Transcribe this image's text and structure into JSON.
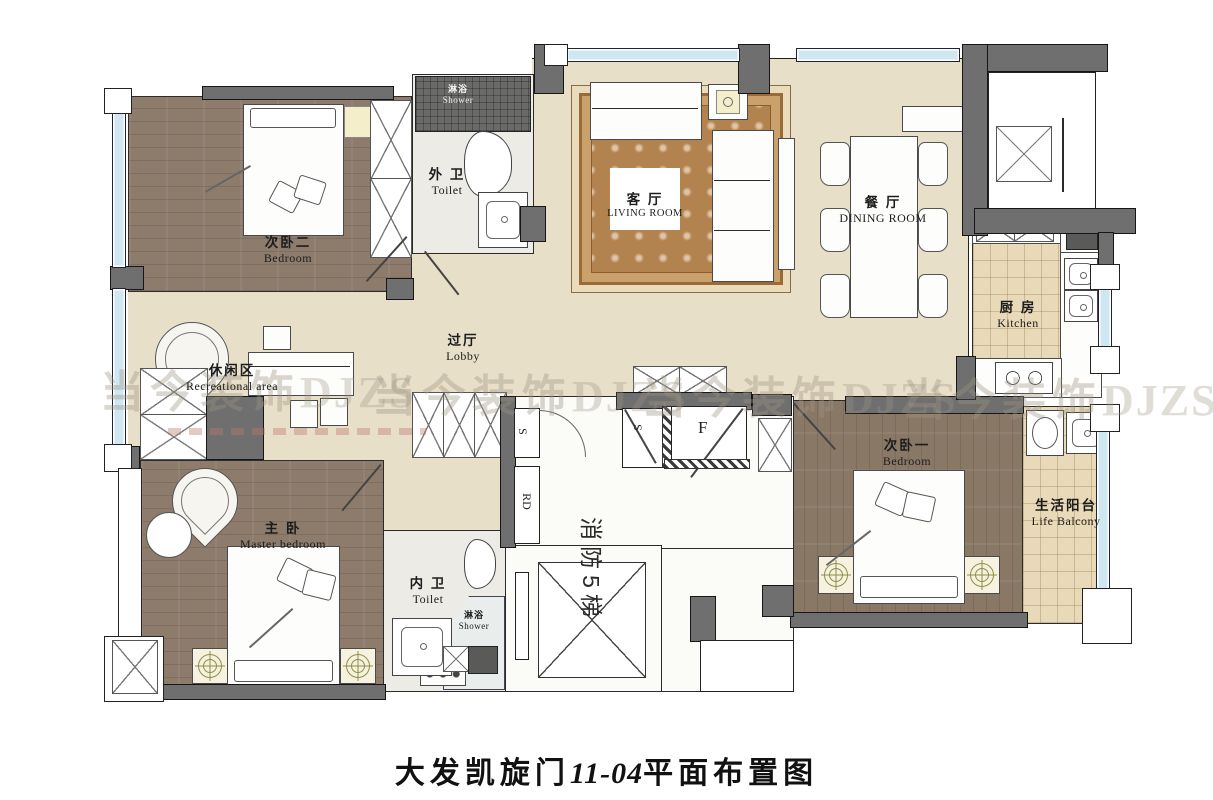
{
  "title": {
    "prefix": "大发凯旋门",
    "unit": "11-04",
    "suffix": "平面布置图"
  },
  "watermark": {
    "cn": "当今装饰",
    "en": "DJZS"
  },
  "rooms": {
    "bedroom2": {
      "zh": "次卧二",
      "en": "Bedroom"
    },
    "outer_toilet": {
      "zh": "外 卫",
      "en": "Toilet"
    },
    "outer_shower": {
      "zh": "淋浴",
      "en": "Shower"
    },
    "living_room": {
      "zh": "客 厅",
      "en": "LIVING ROOM"
    },
    "dining_room": {
      "zh": "餐 厅",
      "en": "DINING ROOM"
    },
    "kitchen": {
      "zh": "厨 房",
      "en": "Kitchen"
    },
    "recreational_area": {
      "zh": "休闲区",
      "en": "Recreational area"
    },
    "lobby": {
      "zh": "过厅",
      "en": "Lobby"
    },
    "master_bedroom": {
      "zh": "主 卧",
      "en": "Master bedroom"
    },
    "inner_toilet": {
      "zh": "内 卫",
      "en": "Toilet"
    },
    "inner_shower": {
      "zh": "淋浴",
      "en": "Shower"
    },
    "bedroom1": {
      "zh": "次卧一",
      "en": "Bedroom"
    },
    "life_balcony": {
      "zh": "生活阳台",
      "en": "Life Balcony"
    },
    "fire_elevator": {
      "label": "消防5梯"
    }
  },
  "door_labels": {
    "entry": "F",
    "s": "S",
    "rd": "RD"
  },
  "colors": {
    "wall": "#6f6f6f",
    "window": "#cfe7f0",
    "floor_beige": "#e8dfc9",
    "floor_wood": "#8d7b6b",
    "floor_tile": "#e8d9b8",
    "rug": "#b2834e",
    "watermark": "#9e9284"
  }
}
